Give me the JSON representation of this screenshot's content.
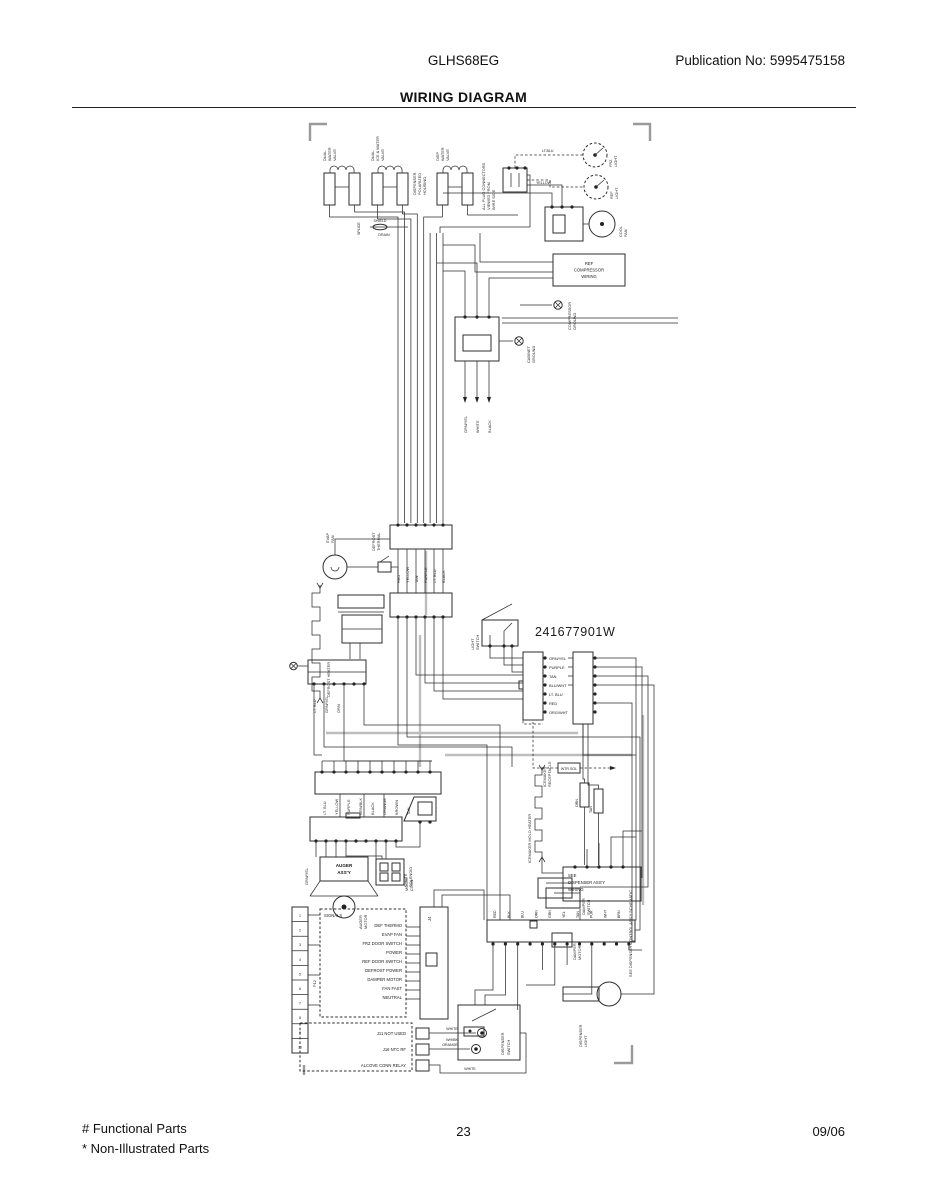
{
  "page": {
    "model": "GLHS68EG",
    "publication": "Publication No:  5995475158",
    "title": "WIRING DIAGRAM",
    "page_number": "23",
    "date_code": "09/06",
    "footnote1": "# Functional Parts",
    "footnote2": "* Non-Illustrated Parts"
  },
  "diagram": {
    "part_number": "241677901W",
    "labels": {
      "valve1": [
        "DUAL",
        "WATER",
        "VALVE"
      ],
      "valve2": [
        "DUAL",
        "ICE & WATER",
        "VALVE"
      ],
      "valve3": [
        "DISP",
        "WATER",
        "VALVE"
      ],
      "housing_note": [
        "DISPENSER",
        "POLARIZED",
        "HOUSING"
      ],
      "plug_note": [
        "ALL PLUG CONNECTORS",
        "VIEWED FROM",
        "WIRE SIDE"
      ],
      "splice": "SPLICE",
      "shield": "SHIELD",
      "drain": "DRAIN",
      "lt_blu": "LT.BLU",
      "yellow": "YELLOW",
      "frz_light": [
        "FRZ",
        "LIGHT"
      ],
      "ref_light": [
        "REF",
        "LIGHT"
      ],
      "cool_fan": [
        "COOL",
        "FAN"
      ],
      "ref_comp_box": [
        "REF",
        "COMPRESSOR",
        "WIRING"
      ],
      "comp_ground": [
        "COMPRESSOR",
        "GROUND"
      ],
      "cabinet_ground": [
        "CABINET",
        "GROUND"
      ],
      "supply_wires": [
        "GRN/YEL",
        "WHITE",
        "BLACK"
      ],
      "connA_wires": [
        "RED",
        "YELLOW",
        "TAN",
        "PURPLE",
        "LT. BLU",
        "BLACK"
      ],
      "defrost_thermal": [
        "DEFROST",
        "THERMAL"
      ],
      "evap_fan": [
        "EVAP",
        "FAN"
      ],
      "defrost_heater": "DEFROST HEATER",
      "ice_cont_wires": [
        "LT. BLU",
        "GRN/YEL",
        "ORN"
      ],
      "light_switch": [
        "LIGHT",
        "SWITCH"
      ],
      "connC_wires": [
        "ORN/YEL",
        "PURPLE",
        "TAN",
        "BLU/WHT",
        "LT. BLU",
        "RED",
        "ORG/WHT"
      ],
      "icemaker_receptacle": [
        "ICEMAKER",
        "RECEPTACLE"
      ],
      "wtr_sol": "WTR SOL",
      "res_orn": "ORN",
      "res_tan": "TAN",
      "mold_heater": "ICEMAKER MOLD HEATER",
      "dispenser_box": [
        "SEE",
        "DISPENSER ASS'Y",
        "WIRING"
      ],
      "dispenser_schematic": "SEE DISPENSER CONTROL ASS'Y SCHEMATIC",
      "connE_wires": [
        "LT. BLU",
        "YELLOW",
        "PURPLE",
        "ORN/BLK",
        "BLACK",
        "ORANGE",
        "BROWN",
        "TAN"
      ],
      "chute_solenoid": [
        "CHUTE",
        "SOLENOID"
      ],
      "auger_assy": [
        "AUGER",
        "ASS'Y"
      ],
      "auger_motor": [
        "AUGER",
        "MOTOR"
      ],
      "grn_yel": "GRN/YEL",
      "molex": [
        "MOLEX",
        "CONN"
      ],
      "strip_pins": [
        "1",
        "2",
        "3",
        "4",
        "5",
        "6",
        "7",
        "8",
        "9",
        "10"
      ],
      "strip_label": "P12",
      "signals_header": "SIGNALS",
      "signals": [
        "DEF THERMO",
        "EVAP FAN",
        "FRZ DOOR SWITCH",
        "POWER",
        "REF DOOR SWITCH",
        "DEFROST POWER",
        "DAMPER MOTOR",
        "FAN FAST",
        "NEUTRAL"
      ],
      "j4": "J4",
      "jlist": [
        "J11 NOT USED",
        "J16 NTC RF",
        "ALCOVE CONN RELAY"
      ],
      "white": "WHITE",
      "wh_bk": "WH/BK",
      "orange": "ORANGE",
      "connG_wires": [
        "RED",
        "BLK",
        "BLU",
        "ORN",
        "GRN",
        "YEL",
        "TAN",
        "PUR",
        "WHT",
        "BRN"
      ],
      "damper_switch": [
        "DAMPER",
        "SWITCH"
      ],
      "damper_motor": [
        "DAMPER",
        "MOTOR"
      ],
      "dispenser_light": [
        "DISPENSER",
        "LIGHT"
      ],
      "dispenser_switch": [
        "DISPENSER",
        "SWITCH"
      ],
      "bottom_part_number": "241677901"
    }
  }
}
